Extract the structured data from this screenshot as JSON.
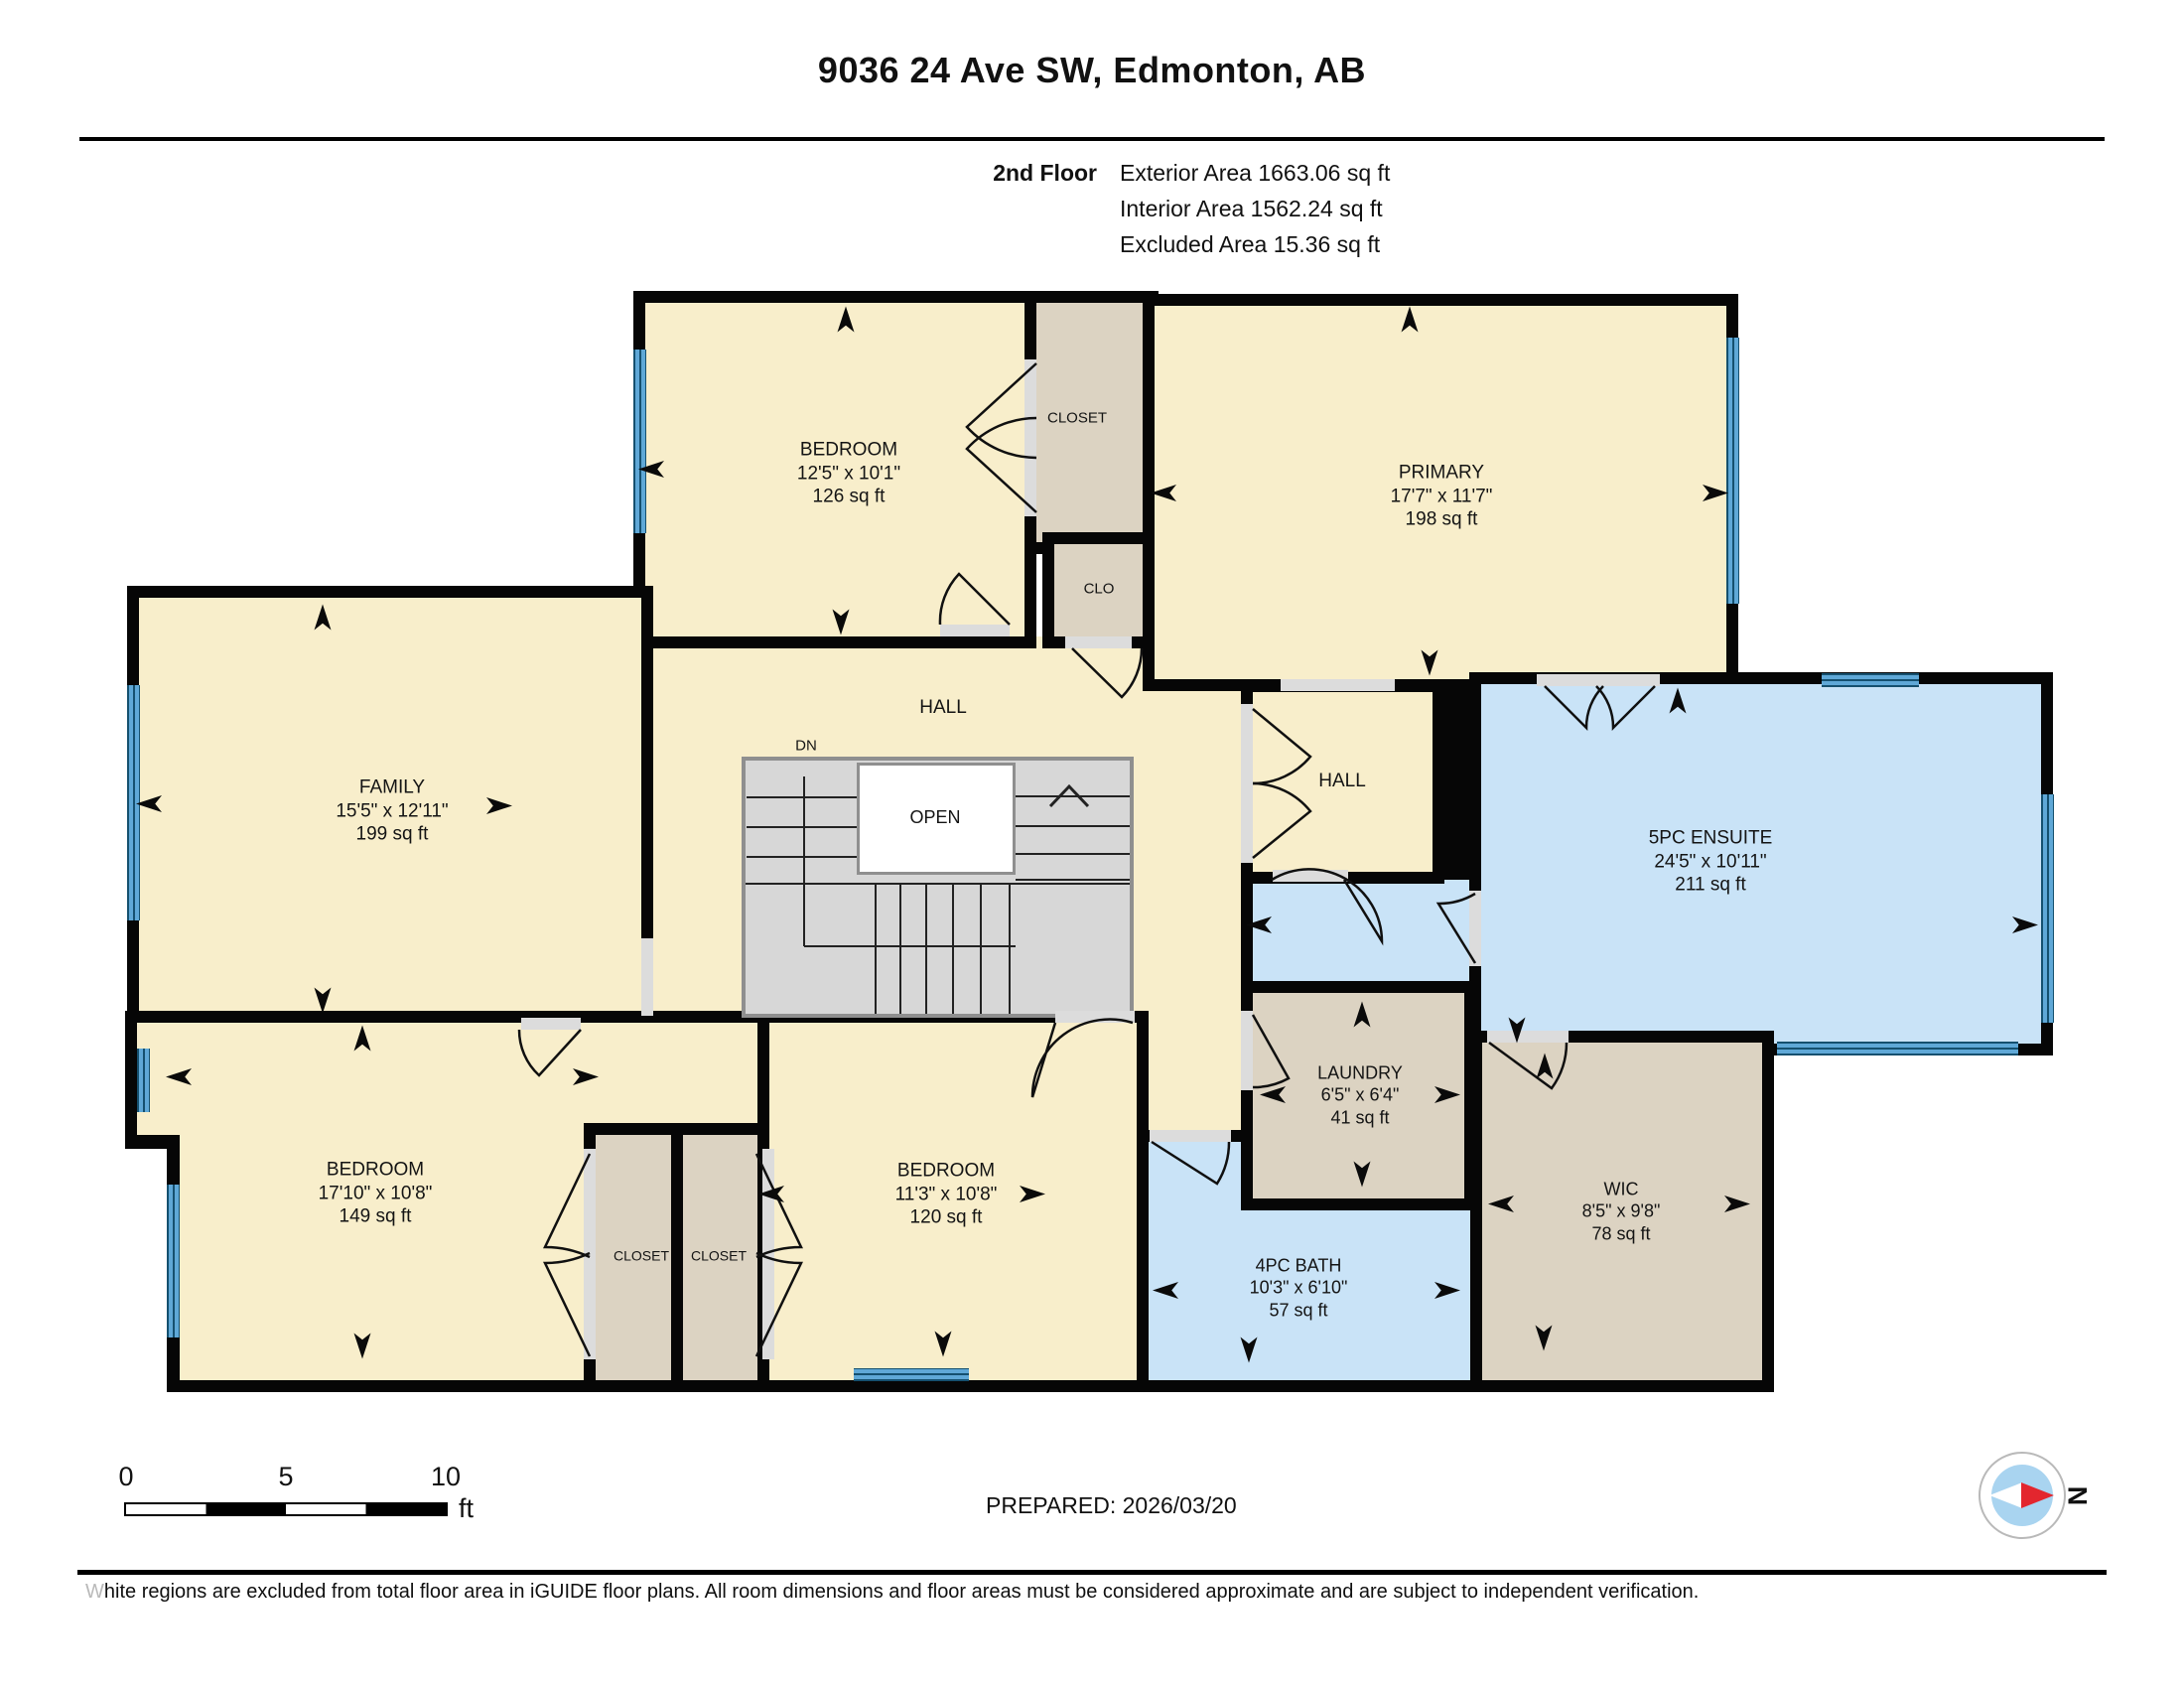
{
  "header": {
    "title": "9036 24 Ave SW, Edmonton, AB",
    "floor_label": "2nd Floor",
    "exterior_area": "Exterior Area 1663.06 sq ft",
    "interior_area": "Interior Area 1562.24 sq ft",
    "excluded_area": "Excluded Area 15.36 sq ft"
  },
  "rooms": {
    "bedroom_top": {
      "name": "BEDROOM",
      "dims": "12'5\" x 10'1\"",
      "area": "126 sq ft"
    },
    "closet_top": {
      "name": "CLOSET"
    },
    "clo": {
      "name": "CLO"
    },
    "primary": {
      "name": "PRIMARY",
      "dims": "17'7\" x 11'7\"",
      "area": "198 sq ft"
    },
    "family": {
      "name": "FAMILY",
      "dims": "15'5\" x 12'11\"",
      "area": "199 sq ft"
    },
    "hall_upper": {
      "name": "HALL"
    },
    "hall_right": {
      "name": "HALL"
    },
    "stairs": {
      "dn": "DN",
      "open": "OPEN"
    },
    "ensuite": {
      "name": "5PC ENSUITE",
      "dims": "24'5\" x 10'11\"",
      "area": "211 sq ft"
    },
    "laundry": {
      "name": "LAUNDRY",
      "dims": "6'5\" x 6'4\"",
      "area": "41 sq ft"
    },
    "bath": {
      "name": "4PC BATH",
      "dims": "10'3\" x 6'10\"",
      "area": "57 sq ft"
    },
    "wic": {
      "name": "WIC",
      "dims": "8'5\" x 9'8\"",
      "area": "78 sq ft"
    },
    "bedroom_left": {
      "name": "BEDROOM",
      "dims": "17'10\" x 10'8\"",
      "area": "149 sq ft"
    },
    "closet_left_1": {
      "name": "CLOSET"
    },
    "closet_left_2": {
      "name": "CLOSET"
    },
    "bedroom_mid": {
      "name": "BEDROOM",
      "dims": "11'3\" x 10'8\"",
      "area": "120 sq ft"
    }
  },
  "scale_bar": {
    "start": "0",
    "mid": "5",
    "end": "10",
    "unit": "ft"
  },
  "prepared": "PREPARED: 2026/03/20",
  "compass": {
    "north_label": "N"
  },
  "footer": {
    "disclaimer": "White regions are excluded from total floor area in iGUIDE floor plans. All room dimensions and floor areas must be considered approximate and are subject to independent verification."
  },
  "colors": {
    "room_fill": "#F8EECB",
    "wet_room_fill": "#C9E3F7",
    "closet_fill": "#DCD3C2",
    "window": "#5FA8D7",
    "wall": "#060606"
  }
}
